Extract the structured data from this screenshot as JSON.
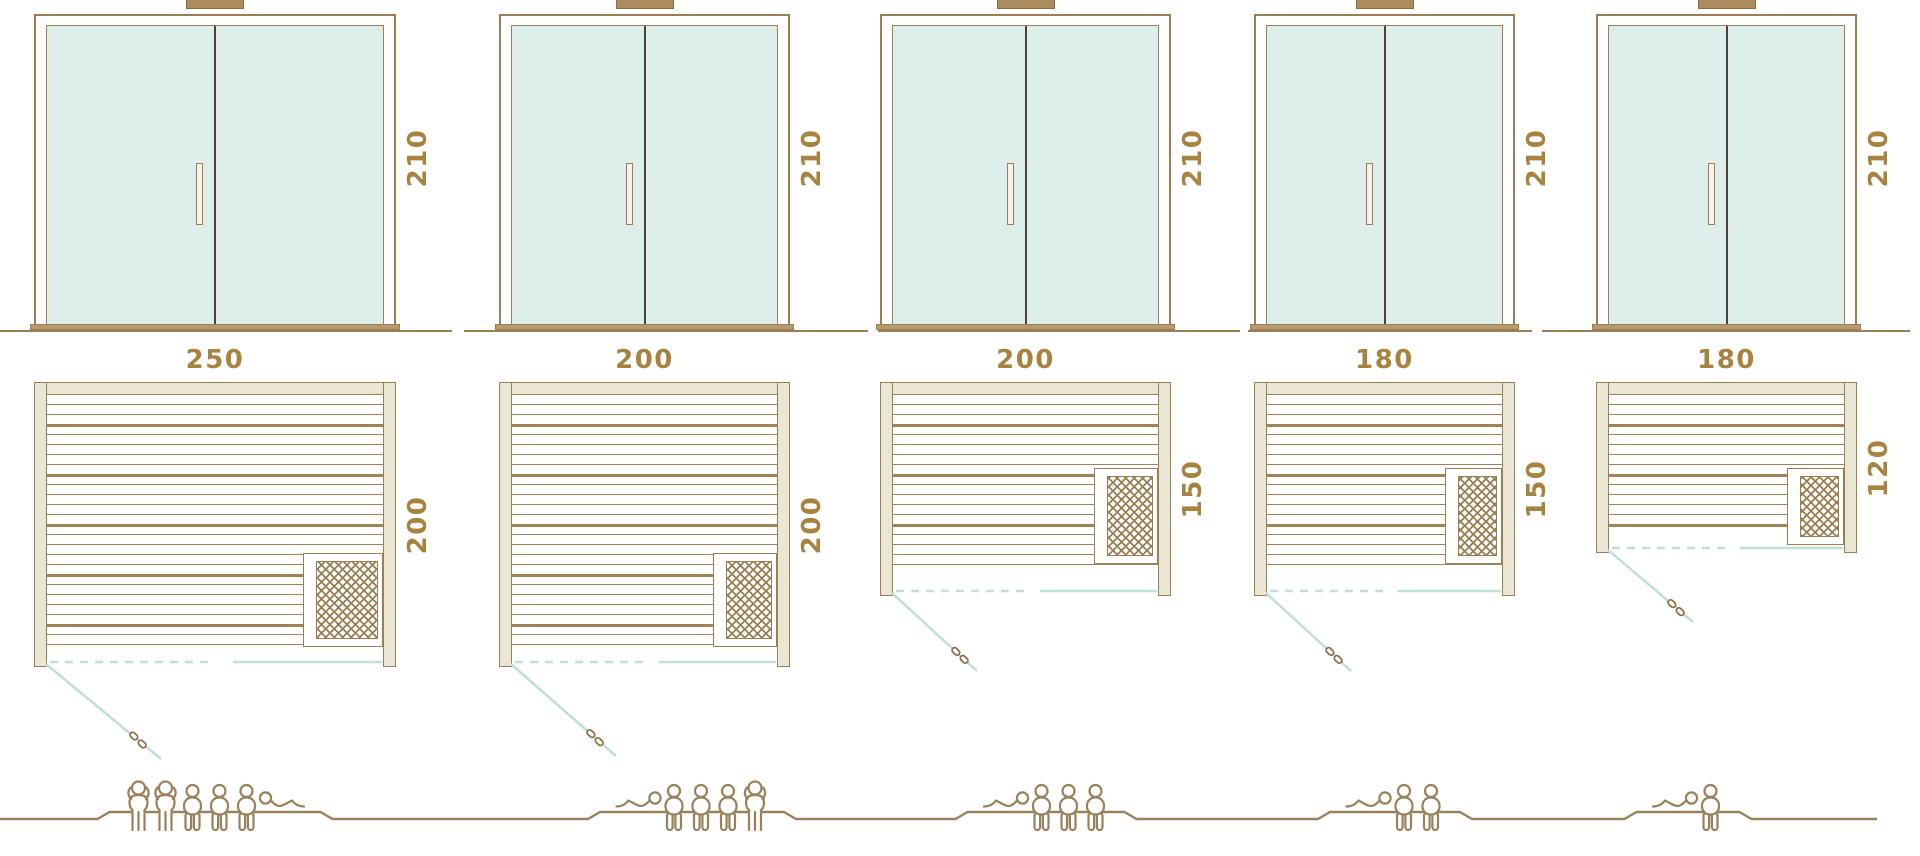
{
  "diagram_title": "",
  "colors": {
    "outline_brown": "#9c7e52",
    "dimension_text": "#a8833f",
    "glass_fill": "#ddeeeb",
    "wall_fill": "#e9e7d4",
    "door_swing_teal": "#bedfda",
    "figure_brown": "#9a815a",
    "divider_dark": "#4c4238"
  },
  "models": [
    {
      "name": "sauna-250x200",
      "height_cm": "210",
      "width_cm": "250",
      "depth_cm": "200",
      "capacity": 6,
      "people": [
        "standing",
        "standing",
        "sitting",
        "sitting",
        "sitting",
        "lying"
      ]
    },
    {
      "name": "sauna-200x200",
      "height_cm": "210",
      "width_cm": "200",
      "depth_cm": "200",
      "capacity": 5,
      "people": [
        "lying",
        "sitting",
        "sitting",
        "sitting",
        "standing"
      ]
    },
    {
      "name": "sauna-200x150",
      "height_cm": "210",
      "width_cm": "200",
      "depth_cm": "150",
      "capacity": 4,
      "people": [
        "lying",
        "sitting",
        "sitting",
        "sitting"
      ]
    },
    {
      "name": "sauna-180x150",
      "height_cm": "210",
      "width_cm": "180",
      "depth_cm": "150",
      "capacity": 3,
      "people": [
        "lying",
        "sitting",
        "sitting"
      ]
    },
    {
      "name": "sauna-180x120",
      "height_cm": "210",
      "width_cm": "180",
      "depth_cm": "120",
      "capacity": 2,
      "people": [
        "lying",
        "sitting"
      ]
    }
  ]
}
